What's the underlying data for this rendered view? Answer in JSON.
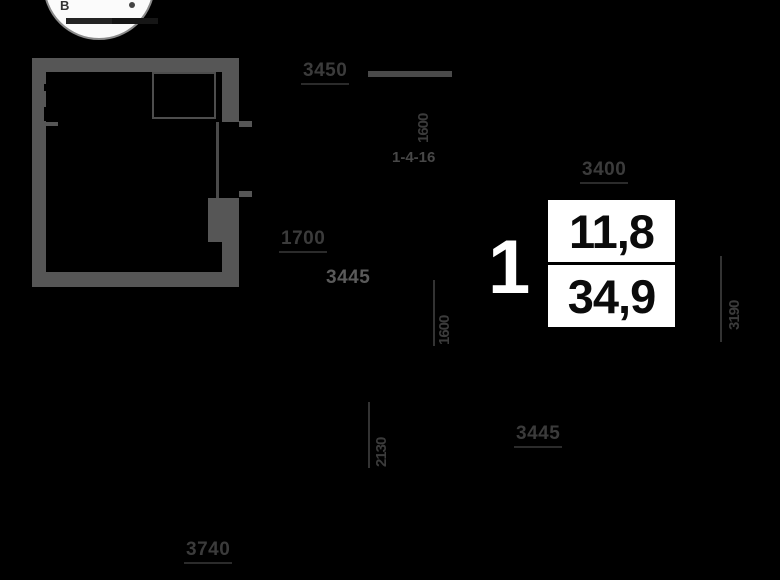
{
  "compass": {
    "east_label": "В"
  },
  "unit": {
    "rooms": "1",
    "living_area": "11,8",
    "total_area": "34,9"
  },
  "dimensions": [
    {
      "value": "3450"
    },
    {
      "value": "1600"
    },
    {
      "value": "1-4-16"
    },
    {
      "value": "1700"
    },
    {
      "value": "3445"
    },
    {
      "value": "1600"
    },
    {
      "value": "2130"
    },
    {
      "value": "3400"
    },
    {
      "value": "3445"
    },
    {
      "value": "3190"
    },
    {
      "value": "3740"
    }
  ],
  "colors": {
    "background": "#000000",
    "walls": "#565656",
    "dimension_text": "#3b3b3b",
    "panel_background": "#ffffff",
    "panel_text": "#0b0b0b",
    "unit_number_text": "#ffffff"
  }
}
